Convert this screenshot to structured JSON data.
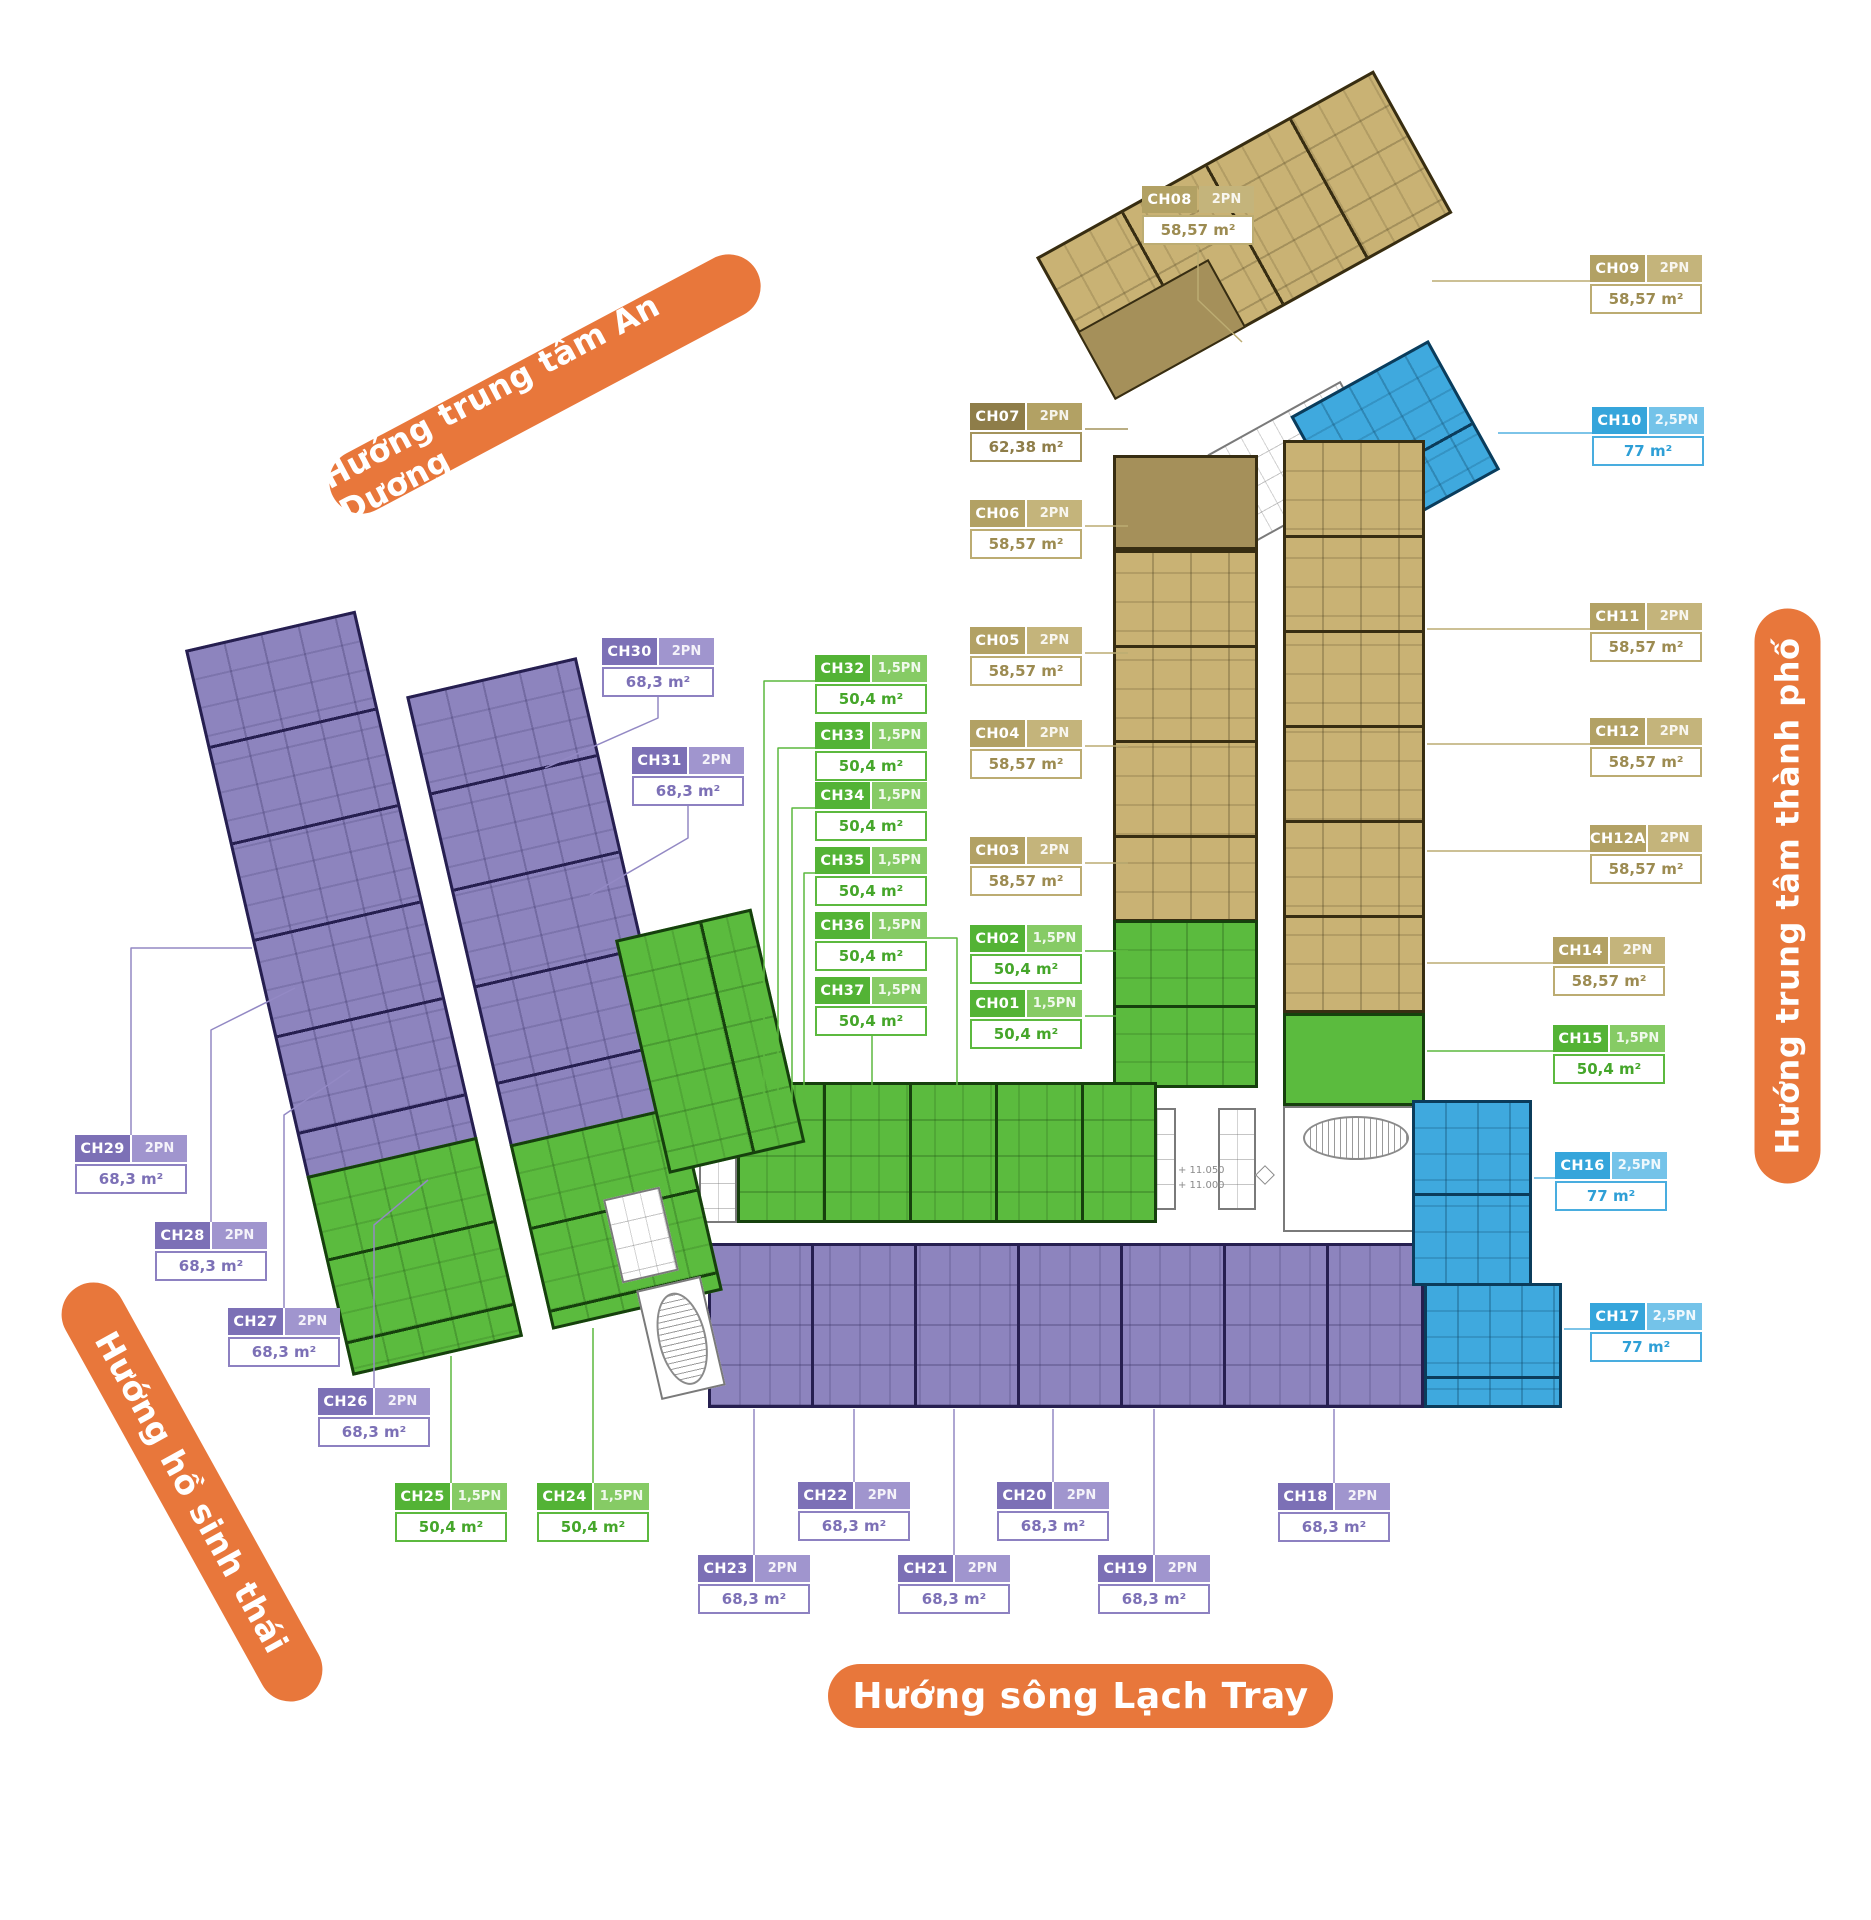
{
  "banners": {
    "an_duong": "Hướng trung tâm An Dương",
    "thanh_pho": "Hướng trung tâm thành phố",
    "ho_sinh_thai": "Hướng hồ sinh thái",
    "lach_tray": "Hướng sông Lạch Tray"
  },
  "plan": {
    "elevation_upper": "+ 11.050",
    "elevation_lower": "+ 11.000"
  },
  "colors": {
    "orange": "#E8773B",
    "tan": "#C9B274",
    "tan_dark": "#A5905A",
    "green": "#5BBB3E",
    "purple": "#8D84BE",
    "blue": "#3FA9DE",
    "leader_tan": "#BCAC72",
    "leader_tandark": "#A4945C",
    "leader_green": "#5CB93F",
    "leader_purple": "#9389C4",
    "leader_blue": "#52B0E0"
  },
  "units": [
    {
      "code": "CH01",
      "type": "1,5PN",
      "area": "50,4 m²",
      "color": "green",
      "x": 970,
      "y": 990,
      "leader": [
        [
          1085,
          1016
        ],
        [
          1128,
          1016
        ]
      ]
    },
    {
      "code": "CH02",
      "type": "1,5PN",
      "area": "50,4 m²",
      "color": "green",
      "x": 970,
      "y": 925,
      "leader": [
        [
          1085,
          951
        ],
        [
          1128,
          951
        ]
      ]
    },
    {
      "code": "CH03",
      "type": "2PN",
      "area": "58,57 m²",
      "color": "tan",
      "x": 970,
      "y": 837,
      "leader": [
        [
          1085,
          863
        ],
        [
          1128,
          863
        ]
      ]
    },
    {
      "code": "CH04",
      "type": "2PN",
      "area": "58,57 m²",
      "color": "tan",
      "x": 970,
      "y": 720,
      "leader": [
        [
          1085,
          746
        ],
        [
          1128,
          746
        ]
      ]
    },
    {
      "code": "CH05",
      "type": "2PN",
      "area": "58,57 m²",
      "color": "tan",
      "x": 970,
      "y": 627,
      "leader": [
        [
          1085,
          653
        ],
        [
          1128,
          653
        ]
      ]
    },
    {
      "code": "CH06",
      "type": "2PN",
      "area": "58,57 m²",
      "color": "tan",
      "x": 970,
      "y": 500,
      "leader": [
        [
          1085,
          526
        ],
        [
          1128,
          526
        ]
      ]
    },
    {
      "code": "CH07",
      "type": "2PN",
      "area": "62,38 m²",
      "color": "tandark",
      "x": 970,
      "y": 403,
      "leader": [
        [
          1085,
          429
        ],
        [
          1128,
          429
        ]
      ]
    },
    {
      "code": "CH08",
      "type": "2PN",
      "area": "58,57 m²",
      "color": "tan",
      "x": 1142,
      "y": 186,
      "leader": [
        [
          1198,
          241
        ],
        [
          1198,
          300
        ],
        [
          1242,
          342
        ]
      ]
    },
    {
      "code": "CH09",
      "type": "2PN",
      "area": "58,57 m²",
      "color": "tan",
      "x": 1590,
      "y": 255,
      "leader": [
        [
          1590,
          281
        ],
        [
          1432,
          281
        ]
      ]
    },
    {
      "code": "CH10",
      "type": "2,5PN",
      "area": "77 m²",
      "color": "blue",
      "x": 1592,
      "y": 407,
      "leader": [
        [
          1592,
          433
        ],
        [
          1498,
          433
        ]
      ]
    },
    {
      "code": "CH11",
      "type": "2PN",
      "area": "58,57 m²",
      "color": "tan",
      "x": 1590,
      "y": 603,
      "leader": [
        [
          1590,
          629
        ],
        [
          1427,
          629
        ]
      ]
    },
    {
      "code": "CH12",
      "type": "2PN",
      "area": "58,57 m²",
      "color": "tan",
      "x": 1590,
      "y": 718,
      "leader": [
        [
          1590,
          744
        ],
        [
          1427,
          744
        ]
      ]
    },
    {
      "code": "CH12A",
      "type": "2PN",
      "area": "58,57 m²",
      "color": "tan",
      "x": 1590,
      "y": 825,
      "leader": [
        [
          1590,
          851
        ],
        [
          1427,
          851
        ]
      ]
    },
    {
      "code": "CH14",
      "type": "2PN",
      "area": "58,57 m²",
      "color": "tan",
      "x": 1553,
      "y": 937,
      "leader": [
        [
          1553,
          963
        ],
        [
          1427,
          963
        ]
      ]
    },
    {
      "code": "CH15",
      "type": "1,5PN",
      "area": "50,4 m²",
      "color": "green",
      "x": 1553,
      "y": 1025,
      "leader": [
        [
          1553,
          1051
        ],
        [
          1427,
          1051
        ]
      ]
    },
    {
      "code": "CH16",
      "type": "2,5PN",
      "area": "77 m²",
      "color": "blue",
      "x": 1555,
      "y": 1152,
      "leader": [
        [
          1555,
          1178
        ],
        [
          1534,
          1178
        ]
      ]
    },
    {
      "code": "CH17",
      "type": "2,5PN",
      "area": "77 m²",
      "color": "blue",
      "x": 1590,
      "y": 1303,
      "leader": [
        [
          1590,
          1329
        ],
        [
          1564,
          1329
        ]
      ]
    },
    {
      "code": "CH18",
      "type": "2PN",
      "area": "68,3 m²",
      "color": "purple",
      "x": 1278,
      "y": 1483,
      "leader": [
        [
          1334,
          1483
        ],
        [
          1334,
          1409
        ]
      ]
    },
    {
      "code": "CH19",
      "type": "2PN",
      "area": "68,3 m²",
      "color": "purple",
      "x": 1098,
      "y": 1555,
      "leader": [
        [
          1154,
          1555
        ],
        [
          1154,
          1409
        ]
      ]
    },
    {
      "code": "CH20",
      "type": "2PN",
      "area": "68,3 m²",
      "color": "purple",
      "x": 997,
      "y": 1482,
      "leader": [
        [
          1053,
          1482
        ],
        [
          1053,
          1409
        ]
      ]
    },
    {
      "code": "CH21",
      "type": "2PN",
      "area": "68,3 m²",
      "color": "purple",
      "x": 898,
      "y": 1555,
      "leader": [
        [
          954,
          1555
        ],
        [
          954,
          1409
        ]
      ]
    },
    {
      "code": "CH22",
      "type": "2PN",
      "area": "68,3 m²",
      "color": "purple",
      "x": 798,
      "y": 1482,
      "leader": [
        [
          854,
          1482
        ],
        [
          854,
          1409
        ]
      ]
    },
    {
      "code": "CH23",
      "type": "2PN",
      "area": "68,3 m²",
      "color": "purple",
      "x": 698,
      "y": 1555,
      "leader": [
        [
          754,
          1555
        ],
        [
          754,
          1409
        ]
      ]
    },
    {
      "code": "CH24",
      "type": "1,5PN",
      "area": "50,4 m²",
      "color": "green",
      "x": 537,
      "y": 1483,
      "leader": [
        [
          593,
          1483
        ],
        [
          593,
          1328
        ]
      ]
    },
    {
      "code": "CH25",
      "type": "1,5PN",
      "area": "50,4 m²",
      "color": "green",
      "x": 395,
      "y": 1483,
      "leader": [
        [
          451,
          1483
        ],
        [
          451,
          1356
        ]
      ]
    },
    {
      "code": "CH26",
      "type": "2PN",
      "area": "68,3 m²",
      "color": "purple",
      "x": 318,
      "y": 1388,
      "leader": [
        [
          374,
          1388
        ],
        [
          374,
          1225
        ],
        [
          428,
          1180
        ]
      ]
    },
    {
      "code": "CH27",
      "type": "2PN",
      "area": "68,3 m²",
      "color": "purple",
      "x": 228,
      "y": 1308,
      "leader": [
        [
          284,
          1308
        ],
        [
          284,
          1115
        ],
        [
          350,
          1070
        ]
      ]
    },
    {
      "code": "CH28",
      "type": "2PN",
      "area": "68,3 m²",
      "color": "purple",
      "x": 155,
      "y": 1222,
      "leader": [
        [
          211,
          1222
        ],
        [
          211,
          1030
        ],
        [
          295,
          988
        ]
      ]
    },
    {
      "code": "CH29",
      "type": "2PN",
      "area": "68,3 m²",
      "color": "purple",
      "x": 75,
      "y": 1135,
      "leader": [
        [
          131,
          1135
        ],
        [
          131,
          948
        ],
        [
          252,
          948
        ]
      ]
    },
    {
      "code": "CH30",
      "type": "2PN",
      "area": "68,3 m²",
      "color": "purple",
      "x": 602,
      "y": 638,
      "leader": [
        [
          658,
          692
        ],
        [
          658,
          718
        ],
        [
          545,
          768
        ]
      ]
    },
    {
      "code": "CH31",
      "type": "2PN",
      "area": "68,3 m²",
      "color": "purple",
      "x": 632,
      "y": 747,
      "leader": [
        [
          688,
          801
        ],
        [
          688,
          838
        ],
        [
          590,
          895
        ]
      ]
    },
    {
      "code": "CH32",
      "type": "1,5PN",
      "area": "50,4 m²",
      "color": "green",
      "x": 815,
      "y": 655,
      "leader": [
        [
          815,
          681
        ],
        [
          764,
          681
        ],
        [
          764,
          1100
        ]
      ]
    },
    {
      "code": "CH33",
      "type": "1,5PN",
      "area": "50,4 m²",
      "color": "green",
      "x": 815,
      "y": 722,
      "leader": [
        [
          815,
          748
        ],
        [
          778,
          748
        ],
        [
          778,
          1100
        ]
      ]
    },
    {
      "code": "CH34",
      "type": "1,5PN",
      "area": "50,4 m²",
      "color": "green",
      "x": 815,
      "y": 782,
      "leader": [
        [
          815,
          808
        ],
        [
          792,
          808
        ],
        [
          792,
          1100
        ]
      ]
    },
    {
      "code": "CH35",
      "type": "1,5PN",
      "area": "50,4 m²",
      "color": "green",
      "x": 815,
      "y": 847,
      "leader": [
        [
          815,
          873
        ],
        [
          804,
          873
        ],
        [
          804,
          1100
        ]
      ]
    },
    {
      "code": "CH36",
      "type": "1,5PN",
      "area": "50,4 m²",
      "color": "green",
      "x": 815,
      "y": 912,
      "leader": [
        [
          927,
          938
        ],
        [
          957,
          938
        ],
        [
          957,
          1098
        ]
      ]
    },
    {
      "code": "CH37",
      "type": "1,5PN",
      "area": "50,4 m²",
      "color": "green",
      "x": 815,
      "y": 977,
      "leader": [
        [
          872,
          1031
        ],
        [
          872,
          1098
        ]
      ]
    }
  ]
}
